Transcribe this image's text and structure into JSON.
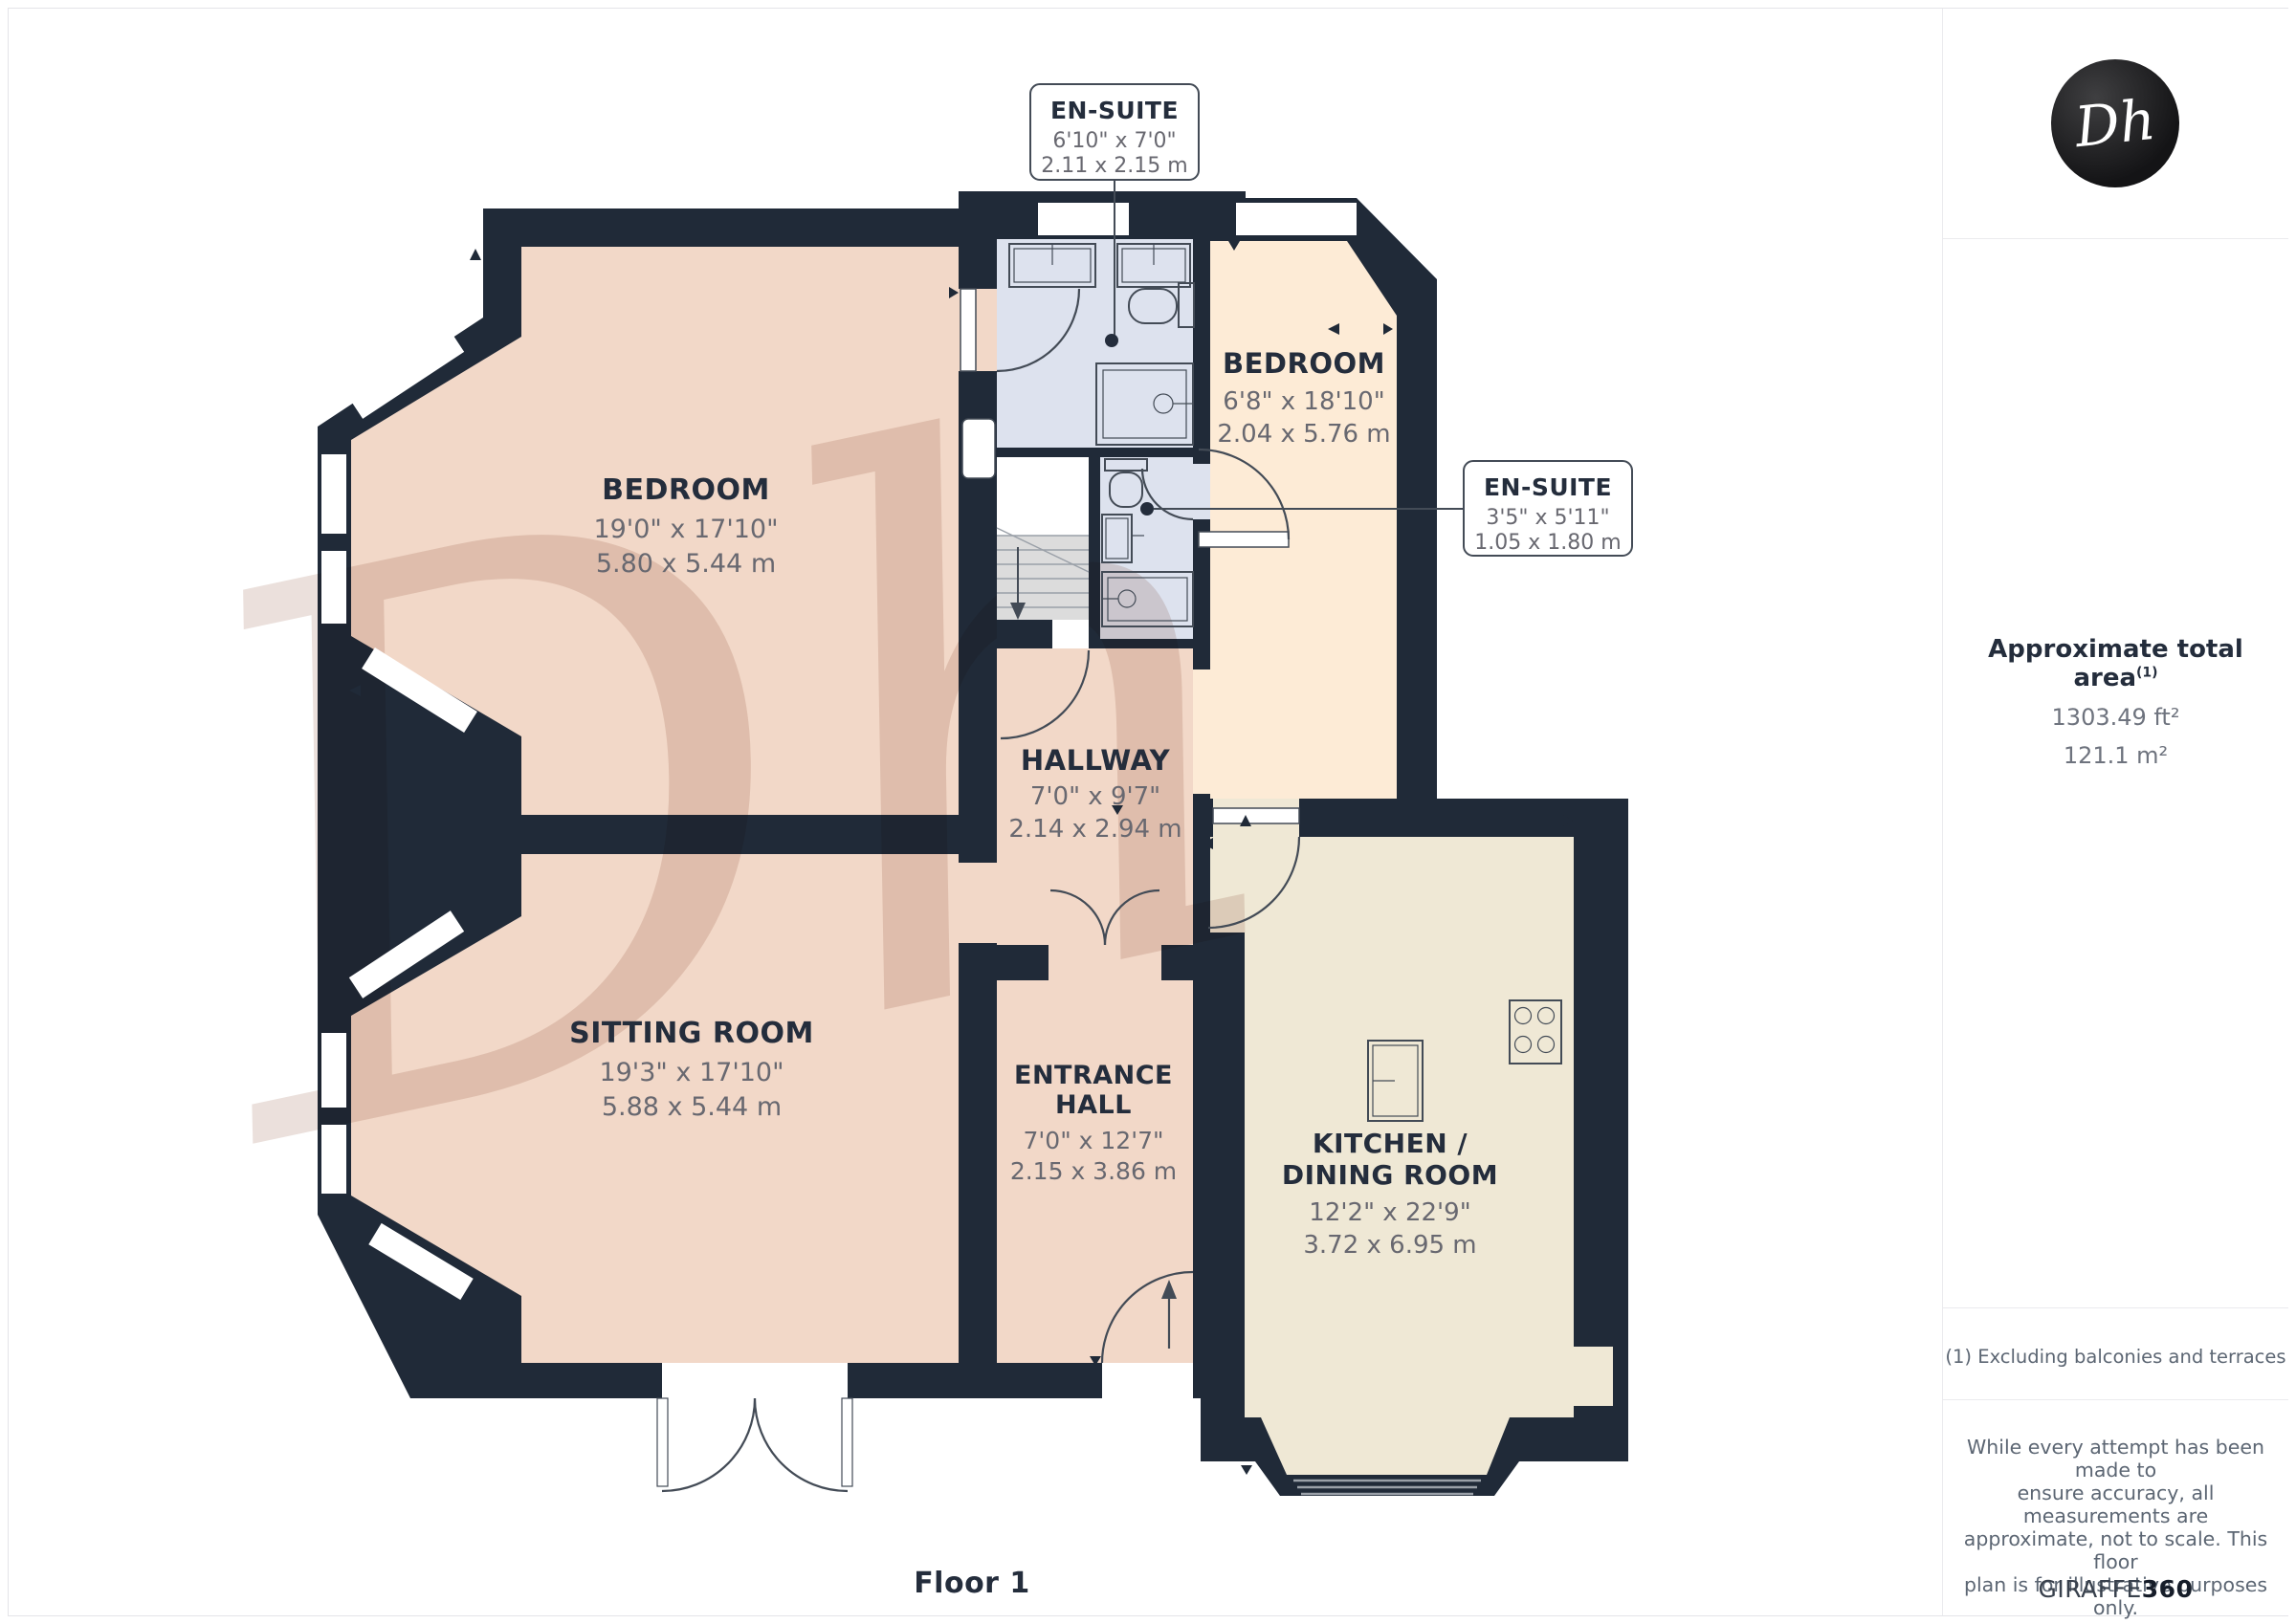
{
  "floor": {
    "label": "Floor 1"
  },
  "watermark": {
    "text": "Dh"
  },
  "colors": {
    "wall": "#202a38",
    "floor_warm": "#f2d8c8",
    "floor_cream": "#fdebd6",
    "floor_kitchen": "#efe8d5",
    "floor_ensuite": "#dde2ee",
    "label_text": "#242d3c",
    "dim_text": "#686870",
    "watermark": "#c9aea1"
  },
  "rooms": {
    "bedroom_left": {
      "name": "BEDROOM",
      "imperial": "19'0\" x 17'10\"",
      "metric": "5.80 x 5.44 m"
    },
    "sitting_room": {
      "name": "SITTING ROOM",
      "imperial": "19'3\" x 17'10\"",
      "metric": "5.88 x 5.44 m"
    },
    "hallway": {
      "name": "HALLWAY",
      "imperial": "7'0\" x 9'7\"",
      "metric": "2.14 x 2.94 m"
    },
    "entrance_hall": {
      "line1": "ENTRANCE",
      "line2": "HALL",
      "imperial": "7'0\" x 12'7\"",
      "metric": "2.15 x 3.86 m"
    },
    "bedroom_right": {
      "name": "BEDROOM",
      "imperial": "6'8\" x 18'10\"",
      "metric": "2.04 x 5.76 m"
    },
    "kitchen_dining": {
      "line1": "KITCHEN /",
      "line2": "DINING ROOM",
      "imperial": "12'2\" x 22'9\"",
      "metric": "3.72 x 6.95 m"
    },
    "ensuite_large": {
      "name": "EN-SUITE",
      "imperial": "6'10\" x 7'0\"",
      "metric": "2.11 x 2.15 m"
    },
    "ensuite_small": {
      "name": "EN-SUITE",
      "imperial": "3'5\" x 5'11\"",
      "metric": "1.05 x 1.80 m"
    }
  },
  "sidebar": {
    "logo": "Dh",
    "area": {
      "title": "Approximate total area",
      "footnote_ref": "(1)",
      "imperial": "1303.49 ft²",
      "metric": "121.1 m²"
    },
    "footnote": "(1) Excluding balconies and terraces",
    "disclaimer": [
      "While every attempt has been made to",
      "ensure accuracy, all measurements are",
      "approximate, not to scale. This floor",
      "plan is for illustrative purposes only."
    ],
    "brand": {
      "prefix": "GIRAFFE",
      "suffix": "360"
    }
  }
}
